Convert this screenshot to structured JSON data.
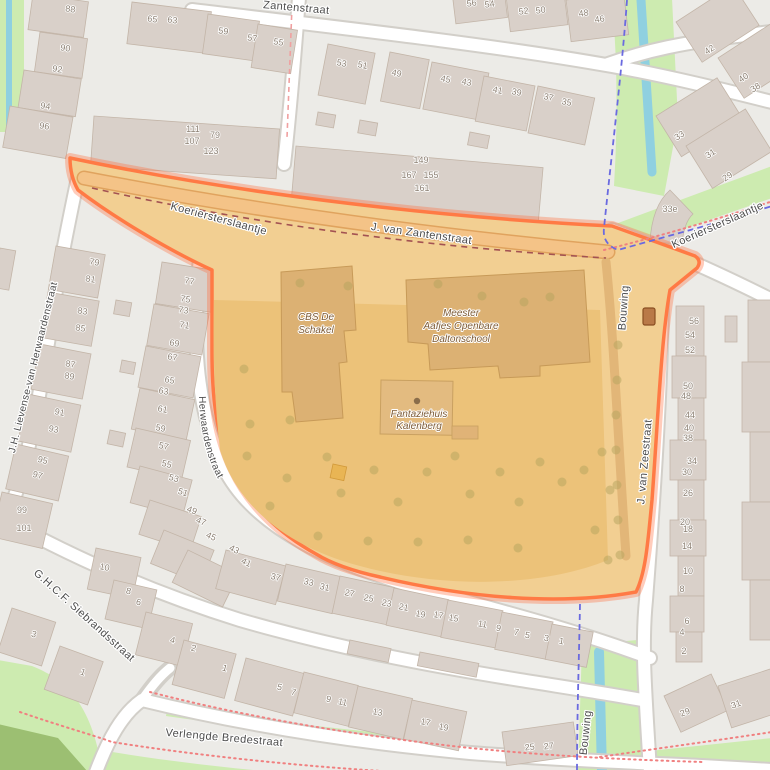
{
  "map_type": "openstreetmap-style street map with highlighted school area",
  "colors": {
    "background": "#ecebe7",
    "building": "#d9d0c9",
    "grass": "#cdebb0",
    "water": "#8fd0e0",
    "highlight_fill": "#f2cf92",
    "highlight_yard": "#ecc279",
    "highlight_building": "#dcb173",
    "highlight_border": "#ff7a45",
    "boundary_dash": "#6a6ae0",
    "path_dots": "#f08080"
  },
  "street_labels": [
    {
      "text": "Koeriersterslaantje",
      "x": 218,
      "y": 222,
      "r": 15
    },
    {
      "text": "J. van Zantenstraat",
      "x": 421,
      "y": 237,
      "r": 8
    },
    {
      "text": "Zantenstraat",
      "x": 296,
      "y": 11,
      "r": 5
    },
    {
      "text": "Koeriersterslaantje",
      "x": 719,
      "y": 228,
      "r": -24
    },
    {
      "text": "J.H. Lievense-van Herwaardenstraat",
      "x": 36,
      "y": 368,
      "r": -76,
      "small": true
    },
    {
      "text": "J.H. Lievense-van Herwaardenstraat",
      "path_id": "p-jhl2",
      "small": true
    },
    {
      "text": "Bouwing",
      "x": 627,
      "y": 308,
      "r": -86
    },
    {
      "text": "J. van Zeestraat",
      "x": 648,
      "y": 462,
      "r": -85
    },
    {
      "text": "Bouwing",
      "x": 589,
      "y": 733,
      "r": -84
    },
    {
      "text": "G.H.C.F. Siebrandsstraat",
      "x": 82,
      "y": 618,
      "r": 42
    },
    {
      "text": "Verlengde Bredestraat",
      "x": 224,
      "y": 741,
      "r": 5
    }
  ],
  "poi_labels": [
    {
      "lines": [
        "CBS De",
        "Schakel"
      ],
      "x": 316,
      "y": 320,
      "lh": 13
    },
    {
      "lines": [
        "Meester",
        "Aafjes Openbare",
        "Daltonschool"
      ],
      "x": 461,
      "y": 316,
      "lh": 13
    },
    {
      "lines": [
        "Fantaziehuis",
        "Kalenberg"
      ],
      "x": 419,
      "y": 417,
      "lh": 12,
      "dot": {
        "x": 417,
        "y": 401
      }
    }
  ],
  "house_numbers": [
    {
      "t": "88",
      "x": 70,
      "y": 12,
      "r": 8
    },
    {
      "t": "90",
      "x": 65,
      "y": 51,
      "r": 8
    },
    {
      "t": "92",
      "x": 57,
      "y": 72,
      "r": 8
    },
    {
      "t": "94",
      "x": 45,
      "y": 109,
      "r": 8
    },
    {
      "t": "96",
      "x": 44,
      "y": 129,
      "r": 8
    },
    {
      "t": "65",
      "x": 152,
      "y": 22,
      "r": 8
    },
    {
      "t": "63",
      "x": 172,
      "y": 23,
      "r": 8
    },
    {
      "t": "59",
      "x": 223,
      "y": 34,
      "r": 8
    },
    {
      "t": "57",
      "x": 252,
      "y": 41,
      "r": 8
    },
    {
      "t": "55",
      "x": 278,
      "y": 45,
      "r": 10
    },
    {
      "t": "53",
      "x": 341,
      "y": 66,
      "r": 12
    },
    {
      "t": "51",
      "x": 362,
      "y": 68,
      "r": 12
    },
    {
      "t": "49",
      "x": 396,
      "y": 76,
      "r": 12
    },
    {
      "t": "45",
      "x": 445,
      "y": 82,
      "r": 12
    },
    {
      "t": "43",
      "x": 466,
      "y": 85,
      "r": 12
    },
    {
      "t": "41",
      "x": 497,
      "y": 93,
      "r": 12
    },
    {
      "t": "39",
      "x": 516,
      "y": 95,
      "r": 12
    },
    {
      "t": "37",
      "x": 548,
      "y": 100,
      "r": 12
    },
    {
      "t": "35",
      "x": 566,
      "y": 105,
      "r": 12
    },
    {
      "t": "56",
      "x": 472,
      "y": 6,
      "r": -8
    },
    {
      "t": "54",
      "x": 490,
      "y": 7,
      "r": -8
    },
    {
      "t": "52",
      "x": 524,
      "y": 14,
      "r": -8
    },
    {
      "t": "50",
      "x": 541,
      "y": 13,
      "r": -8
    },
    {
      "t": "48",
      "x": 584,
      "y": 16,
      "r": -8
    },
    {
      "t": "46",
      "x": 600,
      "y": 22,
      "r": -8
    },
    {
      "t": "111",
      "x": 193,
      "y": 132,
      "r": 0
    },
    {
      "t": "107",
      "x": 192,
      "y": 144,
      "r": 0
    },
    {
      "t": "79",
      "x": 215,
      "y": 138,
      "r": 0
    },
    {
      "t": "123",
      "x": 211,
      "y": 154,
      "r": 0
    },
    {
      "t": "149",
      "x": 421,
      "y": 163,
      "r": 0
    },
    {
      "t": "167",
      "x": 409,
      "y": 178,
      "r": 0
    },
    {
      "t": "155",
      "x": 431,
      "y": 178,
      "r": 0
    },
    {
      "t": "161",
      "x": 422,
      "y": 191,
      "r": 0
    },
    {
      "t": "42",
      "x": 711,
      "y": 52,
      "r": -33
    },
    {
      "t": "40",
      "x": 745,
      "y": 80,
      "r": -33
    },
    {
      "t": "38",
      "x": 757,
      "y": 90,
      "r": -33
    },
    {
      "t": "33",
      "x": 681,
      "y": 138,
      "r": -33
    },
    {
      "t": "31",
      "x": 712,
      "y": 156,
      "r": -33
    },
    {
      "t": "29",
      "x": 729,
      "y": 179,
      "r": -33
    },
    {
      "t": "33e",
      "x": 670,
      "y": 212,
      "r": 0
    },
    {
      "t": "56",
      "x": 694,
      "y": 324,
      "r": 0
    },
    {
      "t": "54",
      "x": 690,
      "y": 338,
      "r": 0
    },
    {
      "t": "52",
      "x": 690,
      "y": 353,
      "r": 0
    },
    {
      "t": "50",
      "x": 688,
      "y": 389,
      "r": 0
    },
    {
      "t": "48",
      "x": 686,
      "y": 399,
      "r": 0
    },
    {
      "t": "44",
      "x": 690,
      "y": 418,
      "r": 0
    },
    {
      "t": "40",
      "x": 689,
      "y": 431,
      "r": 0
    },
    {
      "t": "38",
      "x": 688,
      "y": 441,
      "r": 0
    },
    {
      "t": "34",
      "x": 692,
      "y": 464,
      "r": 0
    },
    {
      "t": "30",
      "x": 687,
      "y": 475,
      "r": 0
    },
    {
      "t": "26",
      "x": 688,
      "y": 496,
      "r": 0
    },
    {
      "t": "20",
      "x": 685,
      "y": 525,
      "r": 0
    },
    {
      "t": "18",
      "x": 688,
      "y": 532,
      "r": 0
    },
    {
      "t": "14",
      "x": 687,
      "y": 549,
      "r": 0
    },
    {
      "t": "10",
      "x": 688,
      "y": 574,
      "r": 0
    },
    {
      "t": "8",
      "x": 682,
      "y": 592,
      "r": 0
    },
    {
      "t": "6",
      "x": 687,
      "y": 624,
      "r": 0
    },
    {
      "t": "4",
      "x": 682,
      "y": 635,
      "r": 0
    },
    {
      "t": "2",
      "x": 684,
      "y": 654,
      "r": 0
    },
    {
      "t": "29",
      "x": 686,
      "y": 715,
      "r": -20
    },
    {
      "t": "31",
      "x": 737,
      "y": 707,
      "r": -20
    },
    {
      "t": "79",
      "x": 94,
      "y": 265,
      "r": 10
    },
    {
      "t": "81",
      "x": 90,
      "y": 282,
      "r": 10
    },
    {
      "t": "83",
      "x": 82,
      "y": 314,
      "r": 10
    },
    {
      "t": "85",
      "x": 80,
      "y": 331,
      "r": 10
    },
    {
      "t": "87",
      "x": 70,
      "y": 367,
      "r": 10
    },
    {
      "t": "89",
      "x": 69,
      "y": 379,
      "r": 10
    },
    {
      "t": "91",
      "x": 59,
      "y": 415,
      "r": 12
    },
    {
      "t": "93",
      "x": 53,
      "y": 432,
      "r": 12
    },
    {
      "t": "95",
      "x": 42,
      "y": 463,
      "r": 14
    },
    {
      "t": "97",
      "x": 37,
      "y": 478,
      "r": 14
    },
    {
      "t": "99",
      "x": 22,
      "y": 513,
      "r": 0
    },
    {
      "t": "101",
      "x": 24,
      "y": 531,
      "r": 0
    },
    {
      "t": "77",
      "x": 189,
      "y": 284,
      "r": 10
    },
    {
      "t": "75",
      "x": 185,
      "y": 302,
      "r": 10
    },
    {
      "t": "73",
      "x": 183,
      "y": 313,
      "r": 10
    },
    {
      "t": "71",
      "x": 184,
      "y": 328,
      "r": 10
    },
    {
      "t": "69",
      "x": 174,
      "y": 346,
      "r": 10
    },
    {
      "t": "67",
      "x": 172,
      "y": 360,
      "r": 10
    },
    {
      "t": "65",
      "x": 169,
      "y": 383,
      "r": 11
    },
    {
      "t": "63",
      "x": 163,
      "y": 394,
      "r": 11
    },
    {
      "t": "61",
      "x": 162,
      "y": 412,
      "r": 12
    },
    {
      "t": "59",
      "x": 160,
      "y": 431,
      "r": 12
    },
    {
      "t": "57",
      "x": 163,
      "y": 449,
      "r": 13
    },
    {
      "t": "55",
      "x": 166,
      "y": 467,
      "r": 14
    },
    {
      "t": "53",
      "x": 173,
      "y": 481,
      "r": 16
    },
    {
      "t": "51",
      "x": 182,
      "y": 495,
      "r": 18
    },
    {
      "t": "49",
      "x": 191,
      "y": 513,
      "r": 20
    },
    {
      "t": "47",
      "x": 200,
      "y": 524,
      "r": 22
    },
    {
      "t": "45",
      "x": 210,
      "y": 539,
      "r": 24
    },
    {
      "t": "43",
      "x": 233,
      "y": 552,
      "r": 26
    },
    {
      "t": "41",
      "x": 245,
      "y": 565,
      "r": 26
    },
    {
      "t": "37",
      "x": 275,
      "y": 580,
      "r": 14
    },
    {
      "t": "33",
      "x": 308,
      "y": 585,
      "r": 13
    },
    {
      "t": "31",
      "x": 324,
      "y": 590,
      "r": 13
    },
    {
      "t": "27",
      "x": 349,
      "y": 596,
      "r": 12
    },
    {
      "t": "25",
      "x": 368,
      "y": 601,
      "r": 12
    },
    {
      "t": "23",
      "x": 386,
      "y": 606,
      "r": 12
    },
    {
      "t": "21",
      "x": 403,
      "y": 610,
      "r": 12
    },
    {
      "t": "19",
      "x": 420,
      "y": 617,
      "r": 11
    },
    {
      "t": "17",
      "x": 438,
      "y": 618,
      "r": 11
    },
    {
      "t": "15",
      "x": 453,
      "y": 621,
      "r": 11
    },
    {
      "t": "11",
      "x": 482,
      "y": 627,
      "r": 11
    },
    {
      "t": "9",
      "x": 498,
      "y": 631,
      "r": 11
    },
    {
      "t": "7",
      "x": 516,
      "y": 635,
      "r": 10
    },
    {
      "t": "5",
      "x": 527,
      "y": 638,
      "r": 10
    },
    {
      "t": "3",
      "x": 546,
      "y": 641,
      "r": 10
    },
    {
      "t": "1",
      "x": 561,
      "y": 644,
      "r": 10
    },
    {
      "t": "5",
      "x": 279,
      "y": 690,
      "r": 14
    },
    {
      "t": "7",
      "x": 293,
      "y": 695,
      "r": 14
    },
    {
      "t": "9",
      "x": 328,
      "y": 702,
      "r": 13
    },
    {
      "t": "11",
      "x": 342,
      "y": 705,
      "r": 13
    },
    {
      "t": "13",
      "x": 377,
      "y": 715,
      "r": 12
    },
    {
      "t": "17",
      "x": 425,
      "y": 725,
      "r": 12
    },
    {
      "t": "19",
      "x": 443,
      "y": 730,
      "r": 12
    },
    {
      "t": "10",
      "x": 104,
      "y": 570,
      "r": 12
    },
    {
      "t": "8",
      "x": 128,
      "y": 594,
      "r": 13
    },
    {
      "t": "6",
      "x": 138,
      "y": 605,
      "r": 13
    },
    {
      "t": "4",
      "x": 172,
      "y": 643,
      "r": 14
    },
    {
      "t": "2",
      "x": 193,
      "y": 651,
      "r": 14
    },
    {
      "t": "1",
      "x": 224,
      "y": 671,
      "r": 16
    },
    {
      "t": "3",
      "x": 33,
      "y": 637,
      "r": 18
    },
    {
      "t": "1",
      "x": 82,
      "y": 675,
      "r": 20
    },
    {
      "t": "25",
      "x": 530,
      "y": 750,
      "r": -6
    },
    {
      "t": "27",
      "x": 549,
      "y": 749,
      "r": -6
    }
  ],
  "trees": [
    {
      "x": 300,
      "y": 283
    },
    {
      "x": 348,
      "y": 286
    },
    {
      "x": 438,
      "y": 284
    },
    {
      "x": 482,
      "y": 296
    },
    {
      "x": 524,
      "y": 302
    },
    {
      "x": 550,
      "y": 297
    },
    {
      "x": 244,
      "y": 369
    },
    {
      "x": 250,
      "y": 424
    },
    {
      "x": 247,
      "y": 456
    },
    {
      "x": 290,
      "y": 420
    },
    {
      "x": 287,
      "y": 478
    },
    {
      "x": 327,
      "y": 457
    },
    {
      "x": 341,
      "y": 493
    },
    {
      "x": 374,
      "y": 470
    },
    {
      "x": 398,
      "y": 502
    },
    {
      "x": 427,
      "y": 472
    },
    {
      "x": 455,
      "y": 456
    },
    {
      "x": 470,
      "y": 494
    },
    {
      "x": 500,
      "y": 472
    },
    {
      "x": 519,
      "y": 502
    },
    {
      "x": 540,
      "y": 462
    },
    {
      "x": 562,
      "y": 482
    },
    {
      "x": 584,
      "y": 470
    },
    {
      "x": 602,
      "y": 452
    },
    {
      "x": 610,
      "y": 490
    },
    {
      "x": 518,
      "y": 548
    },
    {
      "x": 468,
      "y": 540
    },
    {
      "x": 418,
      "y": 542
    },
    {
      "x": 368,
      "y": 541
    },
    {
      "x": 318,
      "y": 536
    },
    {
      "x": 270,
      "y": 506
    },
    {
      "x": 595,
      "y": 530
    },
    {
      "x": 608,
      "y": 560
    },
    {
      "x": 618,
      "y": 345
    },
    {
      "x": 617,
      "y": 380
    },
    {
      "x": 616,
      "y": 415
    },
    {
      "x": 616,
      "y": 450
    },
    {
      "x": 617,
      "y": 485
    },
    {
      "x": 618,
      "y": 520
    },
    {
      "x": 620,
      "y": 555
    }
  ],
  "icons": [
    {
      "name": "gate-icon",
      "x": 643,
      "y": 308
    }
  ]
}
